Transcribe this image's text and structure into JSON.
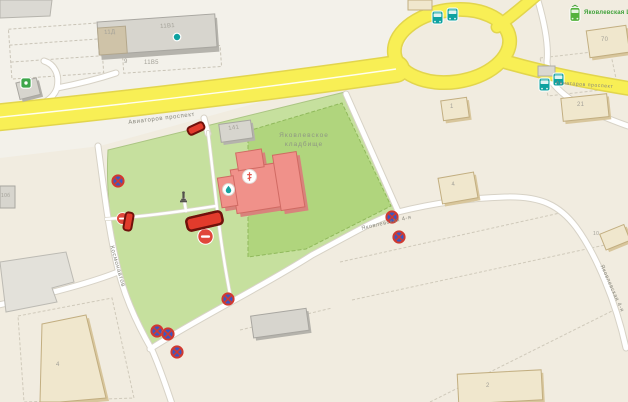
{
  "map": {
    "region_labels": {
      "cemetery_line1": "Яковлевское",
      "cemetery_line2": "кладбище"
    },
    "street_labels": {
      "highway": "Авиаторов проспект",
      "kosmonavtov": "Космонавтов",
      "yakovlevskaya_4": "Яковлевская 4-я"
    },
    "transit": {
      "tram_stop_name": "Яковлевская Церковь"
    },
    "building_labels": {
      "b11d": "11Д",
      "b11v1": "11В1",
      "b9": "9",
      "b11v5": "11В5",
      "b141": "141",
      "b10b": "10б",
      "b4_east": "4",
      "b1": "1",
      "b21": "21",
      "b70": "70",
      "b10": "10",
      "b4_sw": "4",
      "b2": "2"
    },
    "icons": {
      "no_stopping": "no-stopping road sign (blue circle, red X)",
      "no_entry": "no-entry road sign (red circle, white bar)",
      "road_closure": "road closure barrier (red brick)",
      "bus": "bus stop",
      "tram": "tram stop",
      "monument": "monument",
      "church_poi": "orthodox church POI",
      "water_poi": "drinking water POI",
      "entrance_dot": "building entrance dot",
      "org_poi": "organization POI"
    },
    "colors": {
      "road_major": "#f8ef55",
      "road_minor": "#ffffff",
      "cemetery_green": "#c6e09e",
      "cemetery_inner_green": "#b0d57d",
      "church_pink": "#f0918a",
      "building_beige": "#f0e7cd",
      "building_gray": "#d7d5ce",
      "sign_red": "#d03a30",
      "sign_blue": "#3d56c0",
      "transit_teal": "#0ea2a0",
      "transit_green": "#54b23c"
    }
  }
}
